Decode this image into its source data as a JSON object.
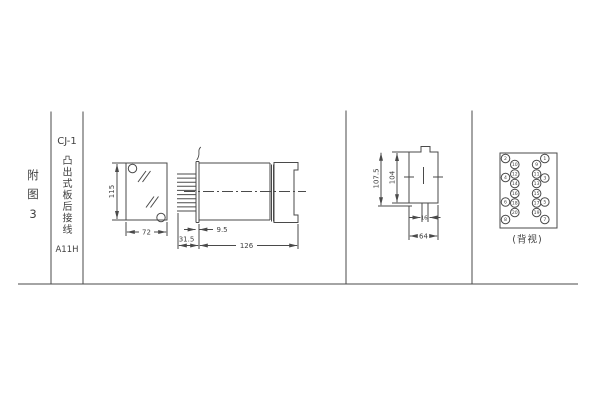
{
  "margin": {
    "figure_label": "附图3"
  },
  "title_block": {
    "model": "CJ-1",
    "wiring_type": "凸出式板后接线",
    "code": "A11H"
  },
  "views": {
    "front": {
      "height_mm": "115",
      "width_mm": "72"
    },
    "side": {
      "flange_offset_mm": "9.5",
      "terminal_depth_mm": "31.5",
      "length_mm": "126"
    },
    "rear": {
      "overall_height_mm": "107.5",
      "inner_height_mm": "104",
      "slot_width_mm": "16",
      "width_mm": "64"
    },
    "terminals": {
      "caption": "(背视)",
      "pins": {
        "outer_left": [
          "2",
          "4",
          "6",
          "8"
        ],
        "inner_left": [
          "10",
          "12",
          "14",
          "16",
          "18",
          "20"
        ],
        "inner_right": [
          "9",
          "11",
          "13",
          "15",
          "17",
          "19"
        ],
        "outer_right": [
          "1",
          "3",
          "5",
          "7"
        ]
      }
    }
  },
  "colors": {
    "line": "#4a4a4a",
    "text": "#3f3f3f",
    "background": "#ffffff"
  }
}
